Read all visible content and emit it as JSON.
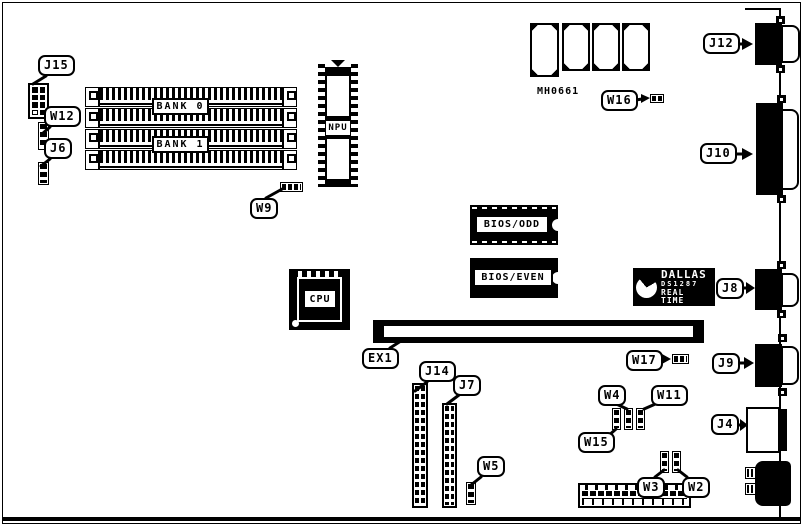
{
  "diagram": {
    "memory": {
      "bank0": "BANK 0",
      "bank1": "BANK 1"
    },
    "chips": {
      "npu": "NPU",
      "cpu": "CPU",
      "bios_odd": "BIOS/ODD",
      "bios_even": "BIOS/EVEN",
      "part_number": "MH0661",
      "rtc": {
        "brand": "DALLAS",
        "part": "DS1287",
        "type": "REAL TIME"
      }
    },
    "callouts": {
      "j15": "J15",
      "w12": "W12",
      "j6": "J6",
      "w9": "W9",
      "ex1": "EX1",
      "j14": "J14",
      "j7": "J7",
      "w5": "W5",
      "w16": "W16",
      "w17": "W17",
      "j12": "J12",
      "j10": "J10",
      "j8": "J8",
      "j9": "J9",
      "j4": "J4",
      "w4": "W4",
      "w11": "W11",
      "w15": "W15",
      "w3": "W3",
      "w2": "W2"
    },
    "colors": {
      "ink": "#000000",
      "paper": "#ffffff"
    }
  }
}
